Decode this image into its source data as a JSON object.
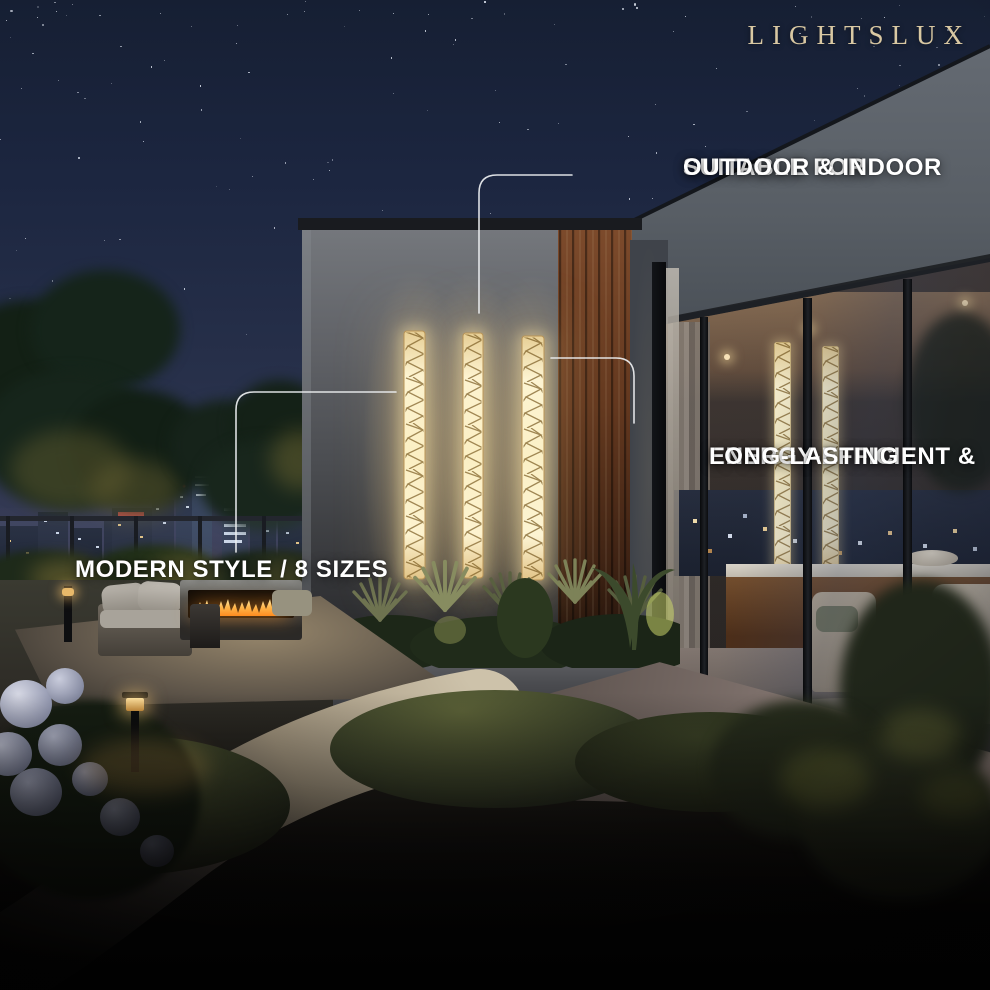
{
  "brand": {
    "logo_text": "LIGHTSLUX"
  },
  "annotations": {
    "suitability": {
      "line1": "SUITABLE FOR",
      "line2": "OUTDOOR & INDOOR"
    },
    "efficiency": {
      "line1": "ENERGY-EFFICIENT &",
      "line2": "LONG-LASTING"
    },
    "style_sizes": {
      "text": "MODERN STYLE / 8 SIZES"
    }
  },
  "colors": {
    "brand_gold": "#d9c8a2",
    "annotation_text": "#ffffff",
    "callout_line": "#eef0f2",
    "light_glow_core": "#fdf4d2",
    "light_glow_edge": "#e7cf96",
    "sky_top": "#161f33",
    "sky_horizon": "#4c4660",
    "flame": "#ff9a2e"
  }
}
